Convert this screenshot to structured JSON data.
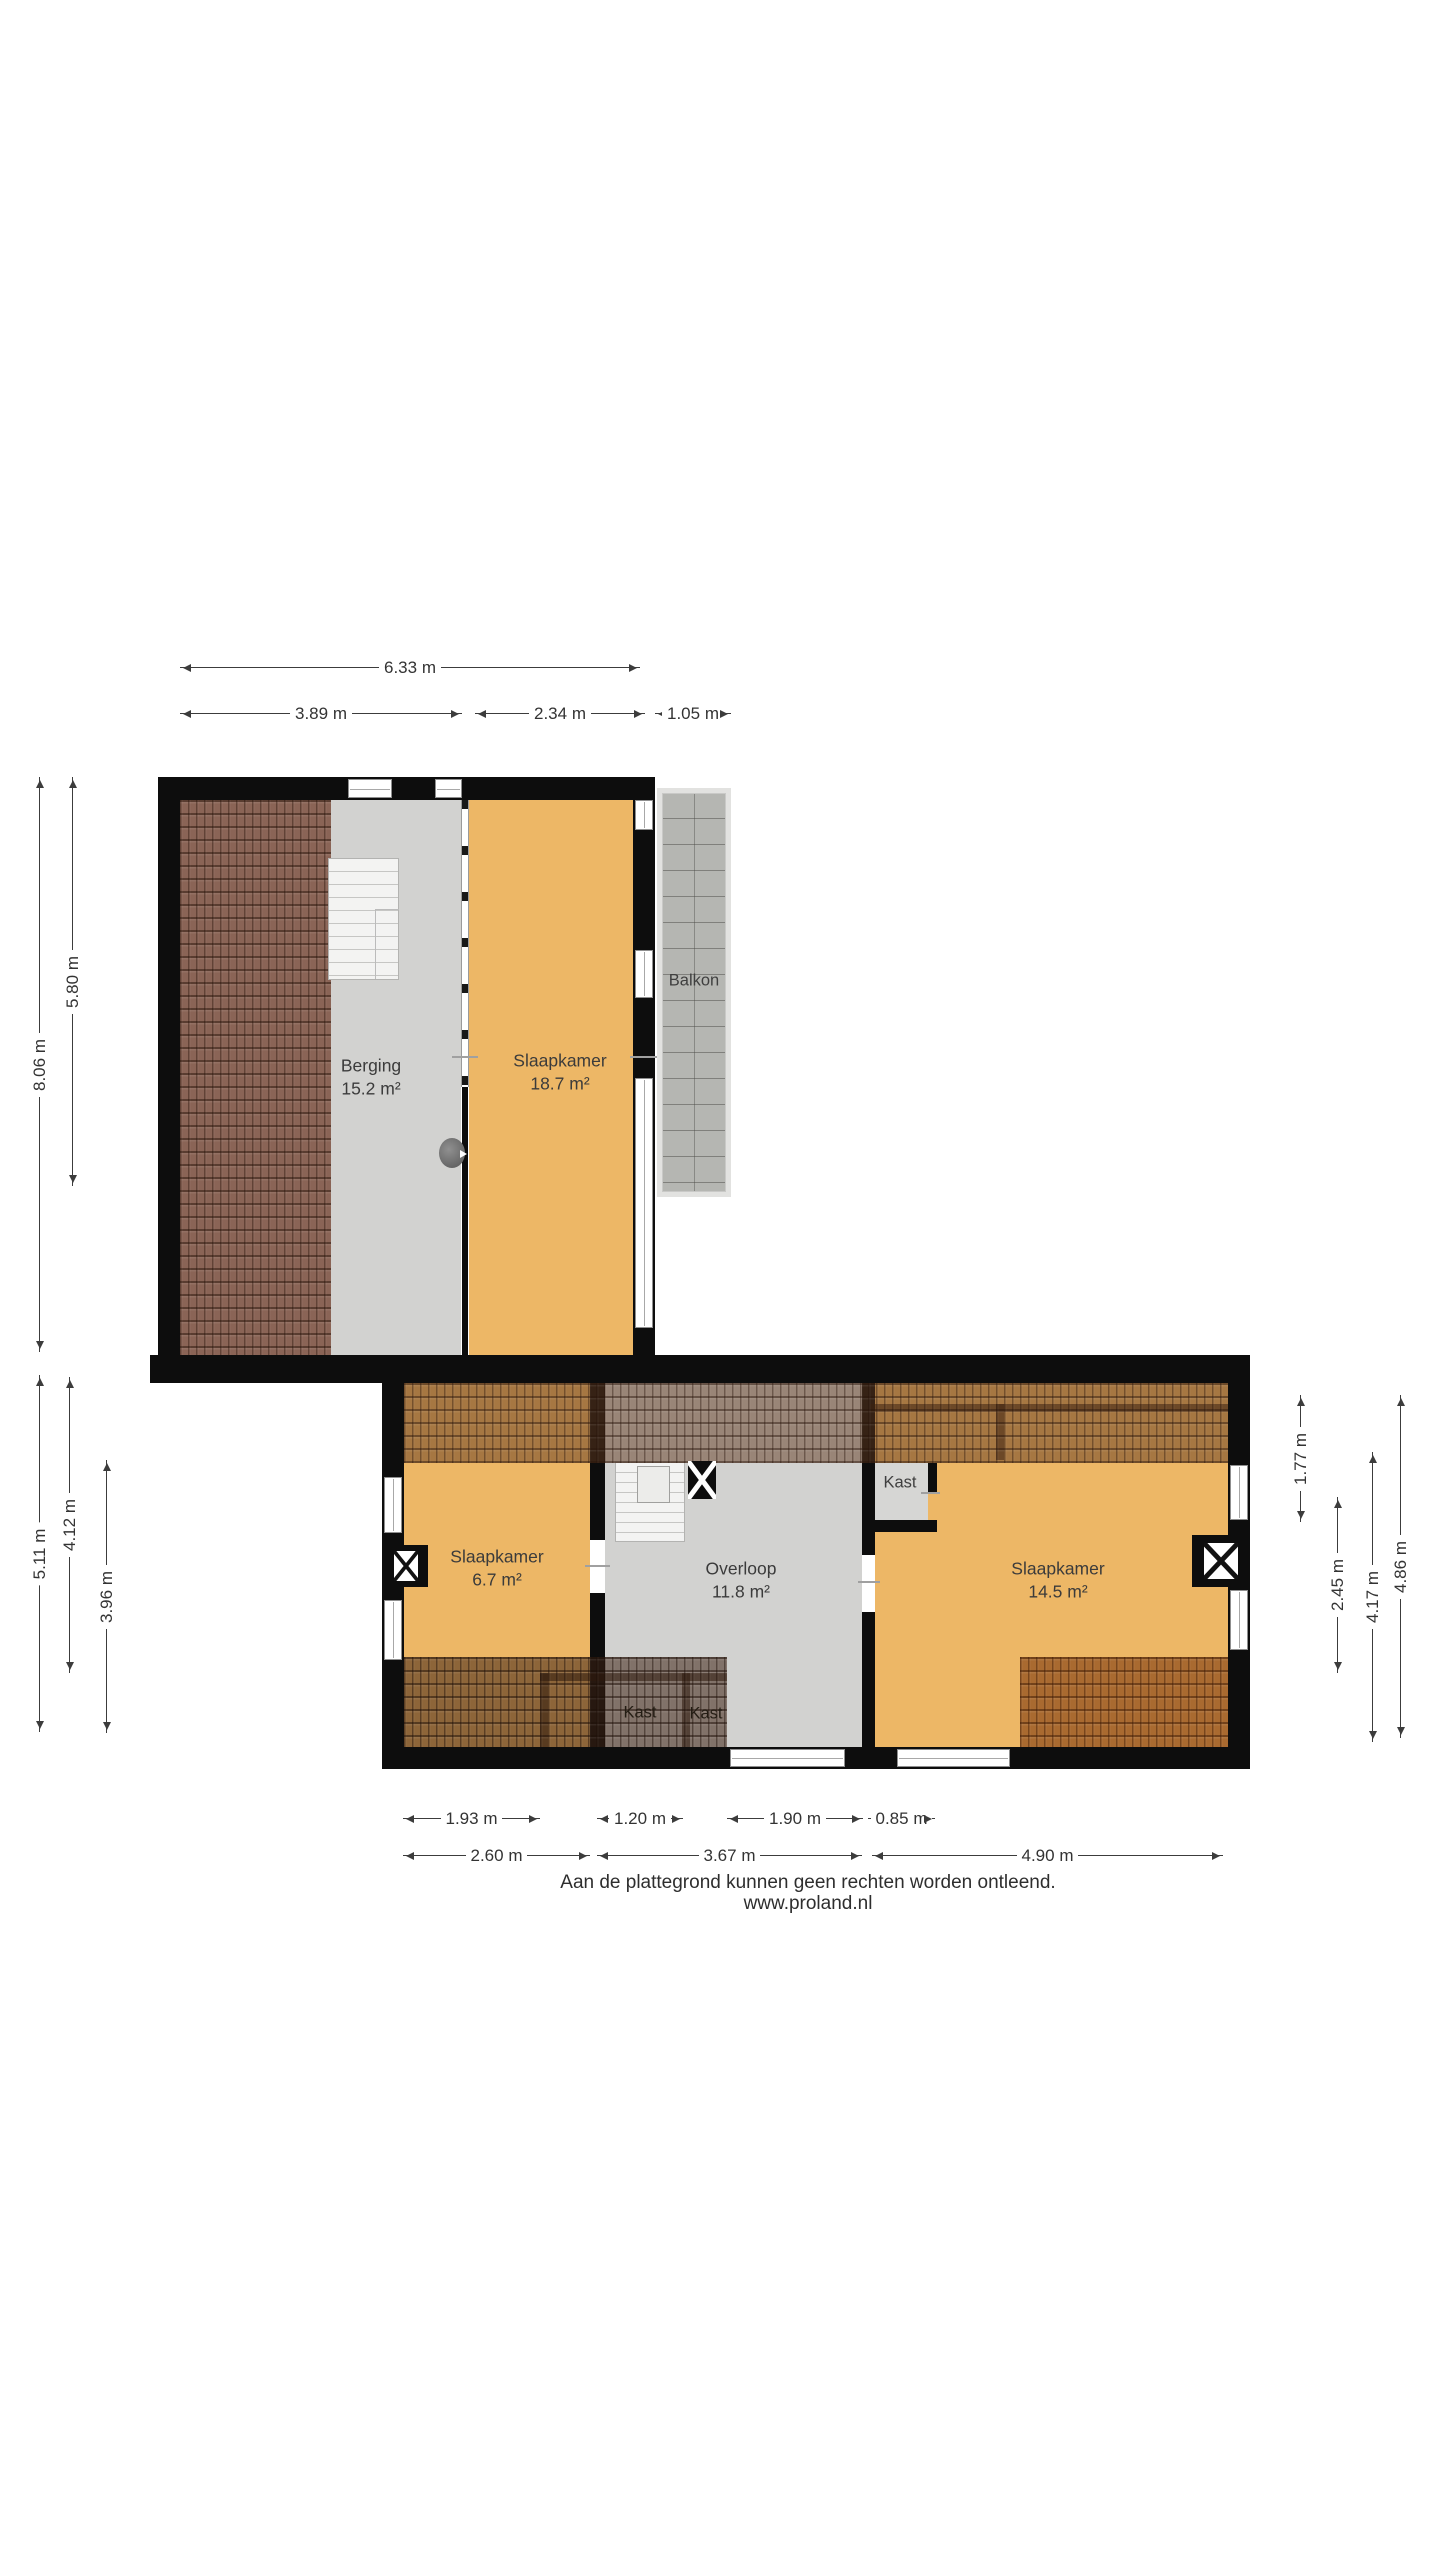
{
  "floorplan": {
    "rooms": {
      "berging": {
        "name": "Berging",
        "area": "15.2 m²"
      },
      "slaapkamer1": {
        "name": "Slaapkamer",
        "area": "18.7 m²"
      },
      "balkon": {
        "name": "Balkon"
      },
      "slaapkamer2": {
        "name": "Slaapkamer",
        "area": "6.7 m²"
      },
      "overloop": {
        "name": "Overloop",
        "area": "11.8 m²"
      },
      "slaapkamer3": {
        "name": "Slaapkamer",
        "area": "14.5 m²"
      },
      "kast1": {
        "name": "Kast"
      },
      "kast2": {
        "name": "Kast"
      },
      "kast3": {
        "name": "Kast"
      }
    },
    "dims": {
      "top": [
        "6.33 m"
      ],
      "top2": [
        "3.89 m",
        "2.34 m",
        "1.05 m"
      ],
      "left_upper": [
        "8.06 m",
        "5.80 m"
      ],
      "left_lower": [
        "5.11 m",
        "4.12 m",
        "3.96 m"
      ],
      "right": [
        "1.77 m",
        "2.45 m",
        "4.17 m",
        "4.86 m"
      ],
      "bottom1": [
        "1.93 m",
        "1.20 m",
        "1.90 m",
        "0.85 m"
      ],
      "bottom2": [
        "2.60 m",
        "3.67 m",
        "4.90 m"
      ]
    },
    "footer": {
      "disclaimer": "Aan de plattegrond kunnen geen rechten worden ontleend.",
      "website": "www.proland.nl"
    }
  }
}
